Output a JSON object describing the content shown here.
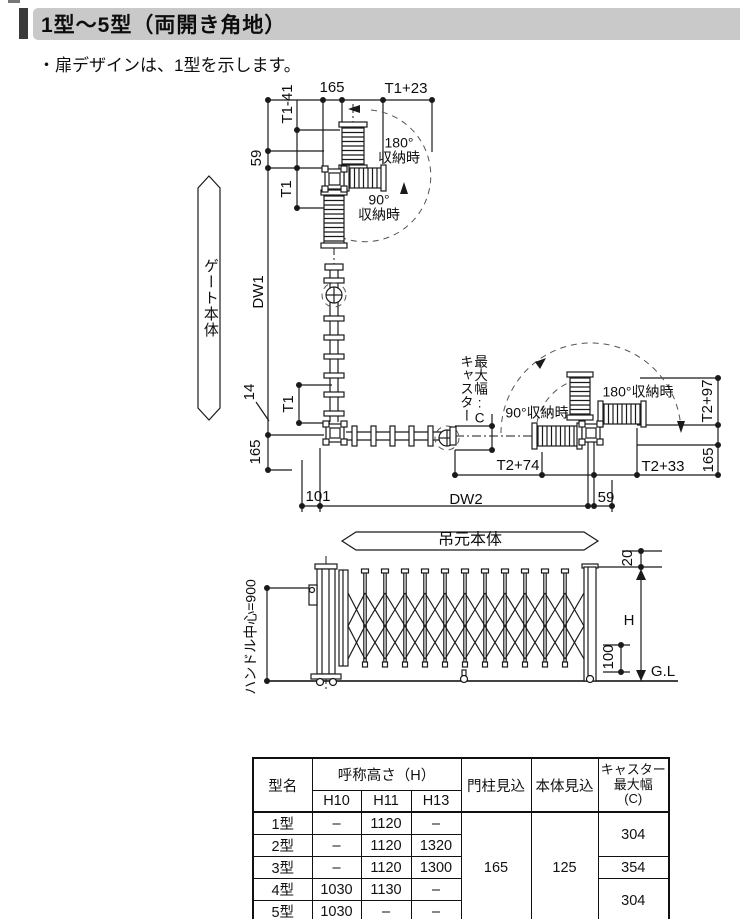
{
  "colors": {
    "title_bar_bg": "#c9c9c9",
    "title_accent": "#3b3b3b",
    "ink": "#1a1a1a"
  },
  "header": {
    "title": "1型～5型（両開き角地）"
  },
  "note": "・扉デザインは、1型を示します。",
  "plan": {
    "labels": {
      "t1_minus_41": "T1-41",
      "dim_165_top": "165",
      "t1_plus_23": "T1+23",
      "dim_59_left": "59",
      "t1_upper": "T1",
      "stored_180_top": {
        "line1": "180°",
        "line2": "収納時"
      },
      "stored_90_top": {
        "line1": "90°",
        "line2": "収納時"
      },
      "gate_body_banner": "ゲート本体",
      "dw1": "DW1",
      "dim_14": "14",
      "t1_lower": "T1",
      "dim_165_bottom_left": "165",
      "caster_max_line1": "キャスター",
      "caster_max_line2": "最大幅:C",
      "stored_90_right": "90°収納時",
      "stored_180_right": "180°収納時",
      "t2_plus_97": "T2+97",
      "dim_165_right": "165",
      "t2_plus_74": "T2+74",
      "t2_plus_33": "T2+33",
      "dim_101": "101",
      "dw2": "DW2",
      "dim_59_bottom": "59",
      "hinge_banner": "吊元本体"
    }
  },
  "elevation": {
    "labels": {
      "handle_center": "ハンドル中心=900",
      "dim_20": "20",
      "height_h": "H",
      "dim_100": "100",
      "ground_level": "G.L"
    }
  },
  "table": {
    "headers": {
      "model": "型名",
      "height_group": "呼称高さ（H）",
      "h10": "H10",
      "h11": "H11",
      "h13": "H13",
      "post_depth": "門柱見込",
      "body_depth": "本体見込",
      "caster_l1": "キャスター",
      "caster_l2": "最大幅",
      "caster_l3": "(C)"
    },
    "rows": [
      {
        "model": "1型",
        "h10": "–",
        "h11": "1120",
        "h13": "–"
      },
      {
        "model": "2型",
        "h10": "–",
        "h11": "1120",
        "h13": "1320"
      },
      {
        "model": "3型",
        "h10": "–",
        "h11": "1120",
        "h13": "1300"
      },
      {
        "model": "4型",
        "h10": "1030",
        "h11": "1130",
        "h13": "–"
      },
      {
        "model": "5型",
        "h10": "1030",
        "h11": "–",
        "h13": "–"
      }
    ],
    "post_depth_value": "165",
    "body_depth_value": "125",
    "caster_width": {
      "models_1_2": "304",
      "model_3": "354",
      "models_4_5": "304"
    }
  }
}
